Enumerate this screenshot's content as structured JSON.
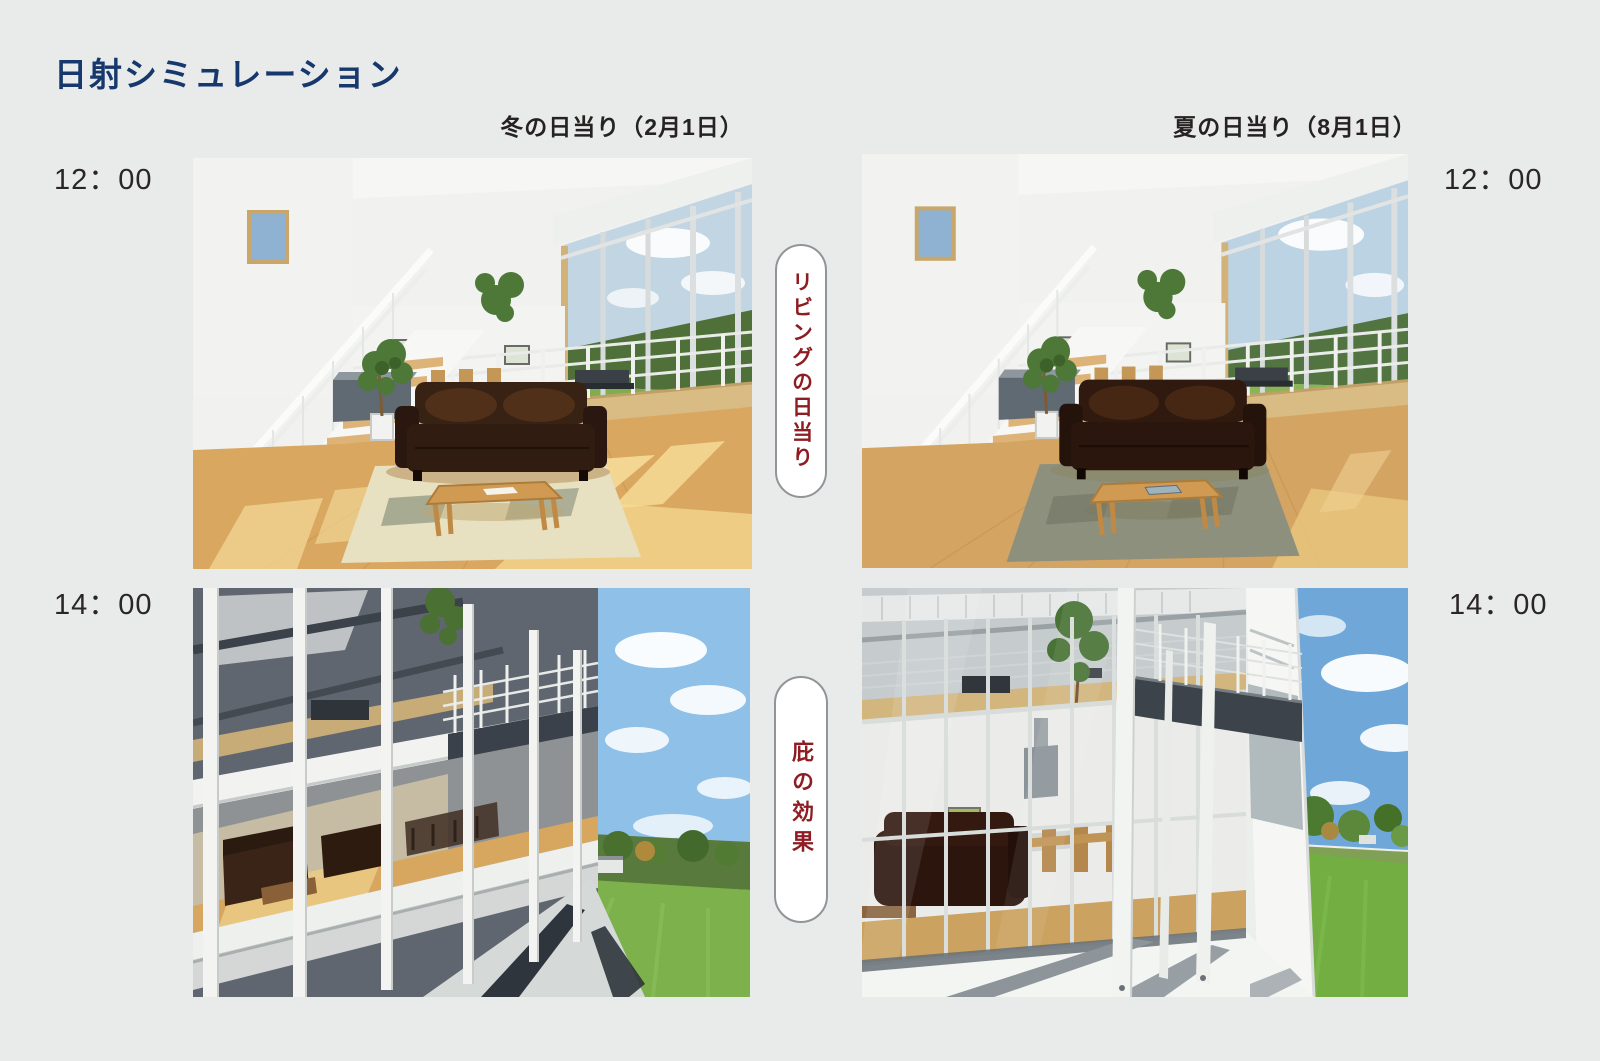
{
  "page": {
    "title": "日射シミュレーション"
  },
  "columns": {
    "winter": {
      "header": "冬の日当り（2月1日）"
    },
    "summer": {
      "header": "夏の日当り（8月1日）"
    }
  },
  "times": {
    "noon": "12：00",
    "afternoon": "14：00"
  },
  "annotations": {
    "living_sunlight": "リビングの日当り",
    "eaves_effect": "庇の効果"
  },
  "colors": {
    "background": "#e9ebea",
    "title_text": "#16386d",
    "heading_text": "#262222",
    "annotation_text": "#8e1d23",
    "pill_background": "#ffffff",
    "pill_border": "#8f9598"
  },
  "renders": {
    "winter_noon": "winter-noon-living-interior-render",
    "summer_noon": "summer-noon-living-interior-render",
    "winter_afternoon": "winter-afternoon-exterior-eaves-render",
    "summer_afternoon": "summer-afternoon-exterior-eaves-render"
  }
}
